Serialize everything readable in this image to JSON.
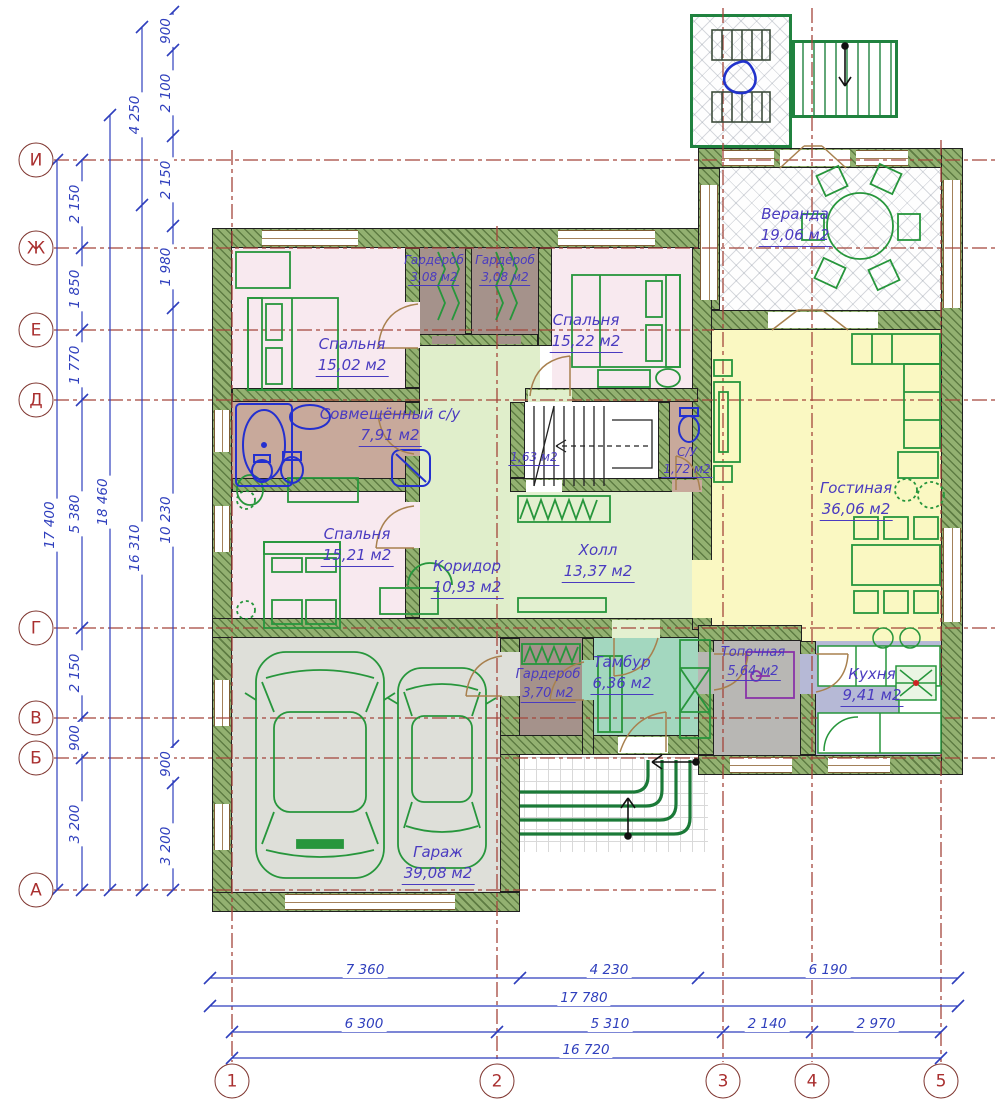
{
  "plan": {
    "rooms": [
      {
        "name": "Веранда",
        "area": "19,06 м2"
      },
      {
        "name": "Спальня",
        "area": "15,02 м2"
      },
      {
        "name": "Гардероб",
        "area": "3,08 м2"
      },
      {
        "name": "Гардероб",
        "area": "3,08 м2"
      },
      {
        "name": "Спальня",
        "area": "15,22 м2"
      },
      {
        "name": "Совмещённый с/у",
        "area": "7,91 м2"
      },
      {
        "name": "",
        "area": "1,63 м2"
      },
      {
        "name": "С/У",
        "area": "1,72 м2"
      },
      {
        "name": "Гостиная",
        "area": "36,06 м2"
      },
      {
        "name": "Спальня",
        "area": "15,21 м2"
      },
      {
        "name": "Коридор",
        "area": "10,93 м2"
      },
      {
        "name": "Холл",
        "area": "13,37 м2"
      },
      {
        "name": "Гардероб",
        "area": "3,70 м2"
      },
      {
        "name": "Тамбур",
        "area": "6,36 м2"
      },
      {
        "name": "Топочная",
        "area": "5,64 м2"
      },
      {
        "name": "Кухня",
        "area": "9,41 м2"
      },
      {
        "name": "Гараж",
        "area": "39,08 м2"
      }
    ],
    "axes": {
      "rows": [
        "И",
        "Ж",
        "Е",
        "Д",
        "Г",
        "В",
        "Б",
        "А"
      ],
      "cols": [
        "1",
        "2",
        "3",
        "4",
        "5"
      ]
    },
    "dims": {
      "left": {
        "total_outer": "17 400",
        "chain_a": [
          "2 150",
          "1 850",
          "1 770",
          "5 380",
          "2 150",
          "900",
          "3 200"
        ],
        "total_mid": "18 460",
        "chain_b": [
          "4 250",
          "16 310"
        ],
        "chain_c": [
          "900",
          "2 100",
          "2 150",
          "1 980",
          "10 230",
          "900",
          "3 200"
        ]
      },
      "bottom": {
        "chain_top": [
          "7 360",
          "4 230",
          "6 190"
        ],
        "total_top": "17 780",
        "chain_bottom": [
          "6 300",
          "5 310",
          "2 140",
          "2 970"
        ],
        "total_bottom": "16 720"
      }
    },
    "colors": {
      "wall_green": "#7f9d5c",
      "dim_blue": "#2f3fbd",
      "axis_red": "#a3453b",
      "label_violet": "#4a3bc0",
      "furniture_green": "#27963c",
      "fixture_blue": "#2430cf",
      "bedroom_pink": "#f8e9ef",
      "living_yellow": "#faf8c2",
      "kitchen_lavender": "#b6b9d6",
      "tambur_teal": "#a3d7bf",
      "hall_green": "#e3f0d0",
      "wardrobe_brown": "#a5928b",
      "bath_tan": "#c8a99b",
      "boiler_gray": "#b8b7b4",
      "garage_gray": "#dedfd9"
    }
  }
}
